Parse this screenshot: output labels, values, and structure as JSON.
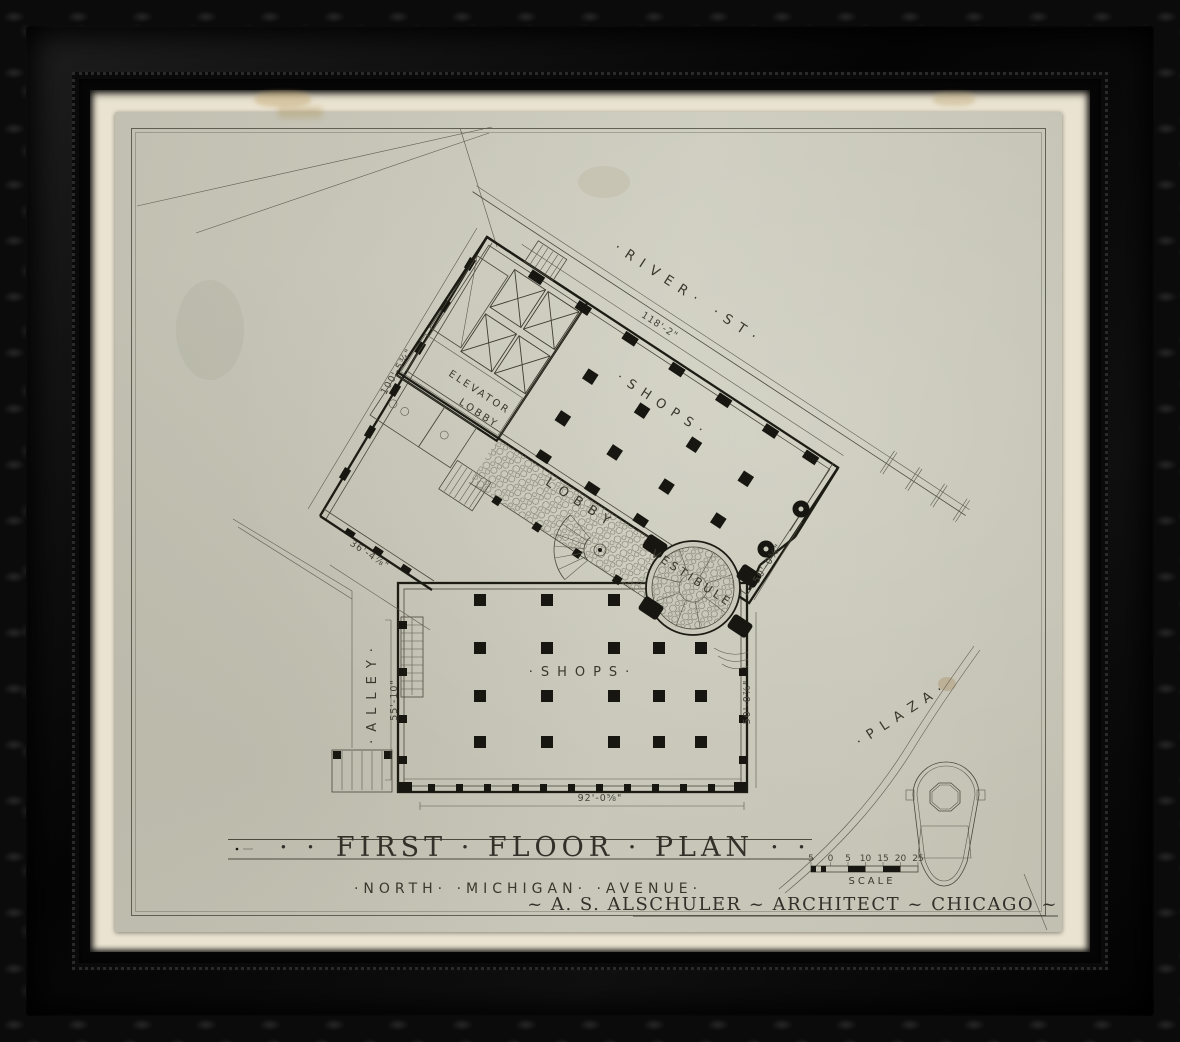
{
  "artwork": {
    "kind": "framed architectural drawing",
    "title_flank_left": "· ·",
    "title": "FIRST · FLOOR · PLAN",
    "title_flank_right": "· ·",
    "avenue_caption": "·NORTH·  ·MICHIGAN·  ·AVENUE·",
    "credit": "~ A. S. ALSCHULER ~ ARCHITECT ~ CHICAGO ~",
    "scale_label": "SCALE",
    "scale_ticks": [
      "5",
      "0",
      "5",
      "10",
      "15",
      "20",
      "25"
    ]
  },
  "plan": {
    "streets": {
      "river": "·RIVER· ·ST·",
      "plaza": "·PLAZA·",
      "alley": "·ALLEY·"
    },
    "rooms": {
      "shops_upper": "·SHOPS·",
      "elevator_lobby_line1": "ELEVATOR",
      "elevator_lobby_line2": "LOBBY",
      "lobby": "LOBBY",
      "vestibule": "VESTIBULE",
      "shops_lower": "·SHOPS·"
    },
    "dimensions": {
      "river_frontage": "118'-2\"",
      "northwest_side": "100'-5¾\"",
      "west_wall": "36'-4⅞\"",
      "alley_side": "55'-10\"",
      "northeast_side": "50'-0⅝\"",
      "east_side": "50'-0⅞\"",
      "michigan_frontage": "92'-0⅝\""
    }
  },
  "colors": {
    "ink": "#34322a",
    "wall_poche": "#171610",
    "paper": "#c8c7b9",
    "mat": "#eae3d1",
    "frame": "#0b0b0b"
  }
}
